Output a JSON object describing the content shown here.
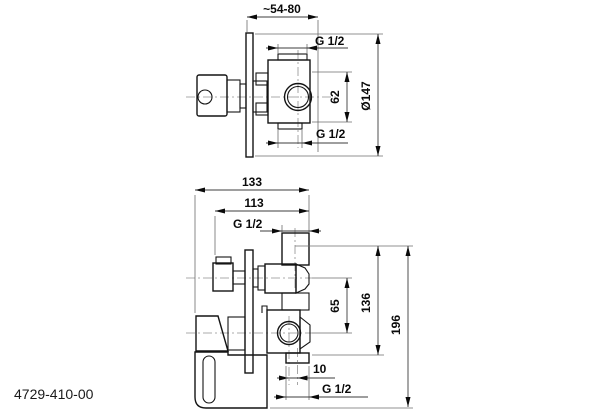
{
  "product_code": "4729-410-00",
  "colors": {
    "background": "#ffffff",
    "object_line": "#141414",
    "dimension_line": "#3c3c3c",
    "centerline": "#909090"
  },
  "side_view": {
    "title": "side view (wall section)",
    "depth": "~54-80",
    "thread_top": "G 1/2",
    "port_spacing": "62",
    "plate_diameter": "Ø147",
    "thread_bottom": "G 1/2"
  },
  "front_view": {
    "title": "front/side view with lever",
    "width_total": "133",
    "width_inner": "113",
    "thread_top": "G 1/2",
    "valve_spacing": "65",
    "height_inner": "136",
    "height_total": "196",
    "outlet_offset": "10",
    "thread_bottom": "G 1/2"
  }
}
